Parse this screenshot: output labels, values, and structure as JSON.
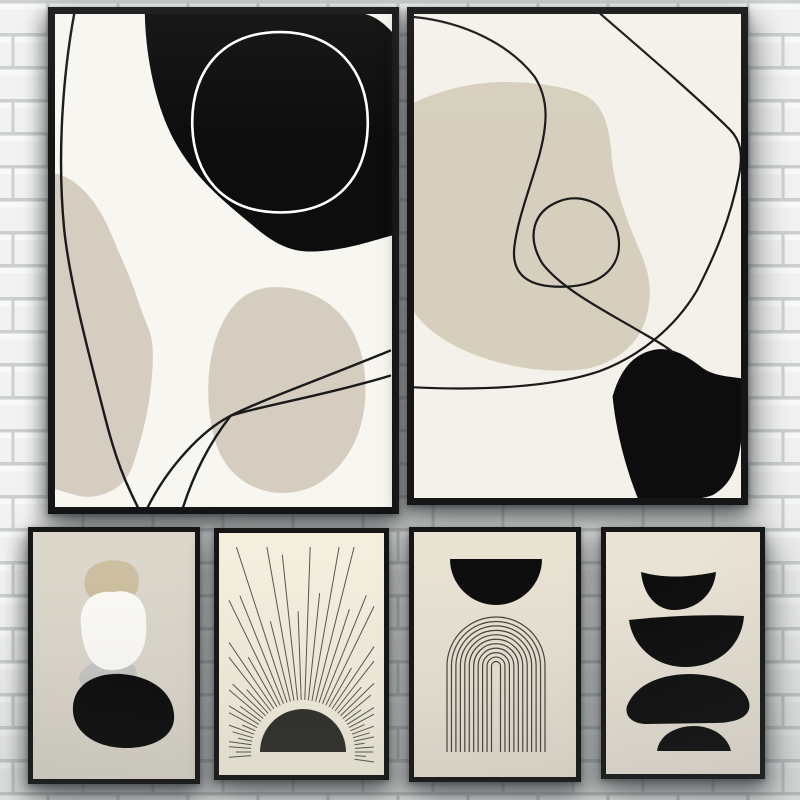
{
  "photo": {
    "subject": "six-framed-abstract-posters-on-white-brick-wall",
    "canvas": {
      "width": 800,
      "height": 800
    }
  },
  "wall": {
    "brick_fill": "#f1f2f1",
    "brick_highlight": "#f8f9f8",
    "mortar_fill": "#cbd0cf",
    "mortar_soft": "#dde1e0",
    "row_height": 33,
    "brick_width": 70
  },
  "palette": {
    "frame": "#161616",
    "ink_black": "#0d0d0d",
    "line_black": "#1a1a1a",
    "beige": "#d5cec0",
    "beige2": "#d6cfbe",
    "cream_white": "#f8f6f0",
    "warm_white": "#f4f1ea",
    "greige": "#dcd7cb",
    "sun_cream": "#f3eedd",
    "arch_beige": "#e8e2d3",
    "stack_beige": "#eae4d6",
    "tan": "#cdbfa0",
    "soft_white": "#fcfbf7",
    "gray_oval": "#c6c6c3",
    "sun_dark": "#31302b",
    "ray_gray": "#5a564c",
    "arch_line": "#47433b"
  },
  "posters": [
    {
      "id": "p1",
      "name": "abstract-blobs-and-lines-left",
      "x": 48,
      "y": 7,
      "w": 351,
      "h": 507,
      "frame": 7,
      "bg": "#f8f6f0",
      "viewBox": "0 0 334 492",
      "shapes": [
        {
          "kind": "path",
          "d": "M 0 159 C 20 163 42 185 56 220 C 66 245 74 260 82 285 C 92 315 97 318 97 340 C 97 375 90 412 77 451 C 68 477 40 486 20 480 L 0 474 Z",
          "fill": "#d5cec0"
        },
        {
          "kind": "path",
          "d": "M 210 273 C 255 269 295 295 305 345 C 313 388 305 440 262 468 C 225 490 175 475 160 430 C 146 388 150 330 172 298 C 185 280 195 276 210 273 Z",
          "fill": "#d5cec0"
        },
        {
          "kind": "path",
          "d": "M 89 0 C 90 42 99 90 118 126 C 138 163 166 186 196 211 C 216 228 232 238 257 237 C 287 236 312 227 334 221 L 334 18 C 325 8 316 2 307 0 Z",
          "fill": "#0d0d0d"
        },
        {
          "kind": "path",
          "d": "M 223 18 C 278 18 310 56 310 108 C 310 163 279 198 223 198 C 167 198 136 161 136 108 C 136 54 168 18 223 18 Z",
          "stroke": "#ffffff",
          "sw": 2.6
        },
        {
          "kind": "path",
          "d": "M 19 0 C 8 60 2 140 9 214 C 14 264 32 334 50 404 C 60 444 70 468 82 492",
          "stroke": "#1a1a1a",
          "sw": 2.4
        },
        {
          "kind": "path",
          "d": "M 332 336 C 270 362 205 385 174 401 C 152 430 138 458 127 492",
          "stroke": "#1a1a1a",
          "sw": 2.4
        },
        {
          "kind": "path",
          "d": "M 332 361 C 262 382 200 392 174 401 C 145 416 112 452 92 492",
          "stroke": "#1a1a1a",
          "sw": 2.4
        }
      ]
    },
    {
      "id": "p2",
      "name": "abstract-scribble-loop-right",
      "x": 407,
      "y": 7,
      "w": 341,
      "h": 498,
      "frame": 7,
      "bg": "#f4f1ea",
      "viewBox": "0 0 326 481",
      "shapes": [
        {
          "kind": "path",
          "d": "M 0 88 C 35 72 70 66 105 68 C 140 70 165 76 177 85 C 190 95 195 115 197 140 C 198 165 210 200 225 235 C 235 258 238 275 232 300 C 226 325 205 345 175 352 C 140 358 100 352 70 342 C 40 332 12 315 0 296 Z",
          "fill": "#d6cfbe"
        },
        {
          "kind": "path",
          "d": "M 198 380 C 206 352 220 338 238 334 C 258 330 272 340 288 352 C 300 360 314 360 326 362 L 326 425 C 323 450 316 468 298 478 C 280 485 250 483 223 481 C 210 448 201 412 198 380 Z",
          "fill": "#0d0d0d"
        },
        {
          "kind": "path",
          "d": "M 0 3 C 50 8 95 30 120 62 C 135 85 133 110 125 140 C 115 175 103 205 100 232 C 97 260 115 272 150 271 C 190 270 210 248 203 217 C 196 190 168 177 145 186 C 118 196 112 222 128 248 C 148 274 192 296 226 316 C 240 324 251 330 258 336",
          "stroke": "#1a1a1a",
          "sw": 2.2
        },
        {
          "kind": "path",
          "d": "M 186 0 C 230 38 285 85 315 115 C 326 126 328 140 324 160 C 315 205 300 240 282 275 C 260 312 225 340 185 355 C 135 372 60 374 0 371",
          "stroke": "#1a1a1a",
          "sw": 2.2
        }
      ]
    },
    {
      "id": "p3",
      "name": "stacked-pebbles-tan-white-black",
      "x": 28,
      "y": 527,
      "w": 172,
      "h": 257,
      "frame": 5,
      "bg": "#dcd7cb",
      "viewBox": "0 0 162 247",
      "shapes": [
        {
          "kind": "path",
          "d": "M 52 46 C 55 32 72 26 88 29 C 103 31 108 43 105 56 C 102 68 88 74 72 72 C 58 70 49 60 52 46 Z",
          "fill": "#cdbfa0"
        },
        {
          "kind": "ellipse",
          "cx": 75,
          "cy": 144,
          "rx": 29,
          "ry": 17,
          "rot": -8,
          "fill": "#c6c6c3"
        },
        {
          "kind": "path",
          "d": "M 48 95 C 45 68 62 58 80 60 C 100 56 114 68 113 90 C 115 116 105 136 82 138 C 60 140 50 122 48 95 Z",
          "fill": "#fcfbf7"
        },
        {
          "kind": "path",
          "d": "M 40 174 C 42 152 62 141 88 142 C 116 144 139 158 141 182 C 143 204 121 216 93 216 C 63 216 38 200 40 174 Z",
          "fill": "#0d0d0d"
        }
      ]
    },
    {
      "id": "p4",
      "name": "rising-sun-with-rays",
      "x": 214,
      "y": 528,
      "w": 175,
      "h": 252,
      "frame": 5,
      "bg": "#f3eedd",
      "viewBox": "0 0 165 242",
      "shapes": [
        {
          "kind": "rays",
          "cx": 84,
          "cy": 219,
          "inner": 52,
          "start": -8,
          "end": 184,
          "step": 4,
          "margin": [
            10,
            14,
            155,
            231
          ],
          "lens": [
            1,
            0.58,
            0.95,
            1,
            0.52,
            1,
            0.8,
            1,
            0.6,
            1,
            1,
            0.55,
            0.9,
            1,
            0.65,
            1,
            1,
            0.5,
            1,
            0.85,
            0.6,
            1,
            1,
            0.7
          ],
          "stroke": "#5a564c",
          "sw": 1
        },
        {
          "kind": "path",
          "d": "M 41 219 A 43 43 0 0 1 127 219 Z",
          "fill": "#31302b"
        }
      ]
    },
    {
      "id": "p5",
      "name": "half-moon-over-arch-lines",
      "x": 409,
      "y": 527,
      "w": 172,
      "h": 255,
      "frame": 5,
      "bg": "#e8e2d3",
      "viewBox": "0 0 162 245",
      "shapes": [
        {
          "kind": "path",
          "d": "M 36 27 L 128 27 A 46 46 0 0 1 36 27 Z",
          "fill": "#0d0d0d"
        },
        {
          "kind": "arch",
          "cx": 82,
          "springY": 134,
          "legBottom": 220,
          "rMax": 49,
          "rMin": 4.5,
          "count": 11,
          "stroke": "#47433b",
          "sw": 1.2
        }
      ]
    },
    {
      "id": "p6",
      "name": "balancing-black-half-discs",
      "x": 601,
      "y": 527,
      "w": 164,
      "h": 252,
      "frame": 5,
      "bg": "#eae4d6",
      "viewBox": "0 0 154 242",
      "shapes": [
        {
          "kind": "path",
          "d": "M 35 40 C 60 47 85 45 110 40 C 108 63 90 78 68 78 C 50 78 37 62 35 40 Z",
          "fill": "#0d0d0d"
        },
        {
          "kind": "path",
          "d": "M 23 88 C 60 84 100 82 138 84 C 136 112 114 135 79 135 C 47 135 26 112 23 88 Z",
          "fill": "#0d0d0d"
        },
        {
          "kind": "path",
          "d": "M 21 174 C 30 152 55 142 85 142 C 115 143 139 153 143 170 C 146 183 134 191 108 191 L 40 192 C 28 192 18 185 21 174 Z",
          "fill": "#0d0d0d"
        },
        {
          "kind": "path",
          "d": "M 51 219 C 53 203 70 194 88 194 C 107 194 122 205 125 219 Z",
          "fill": "#0d0d0d"
        }
      ]
    }
  ]
}
